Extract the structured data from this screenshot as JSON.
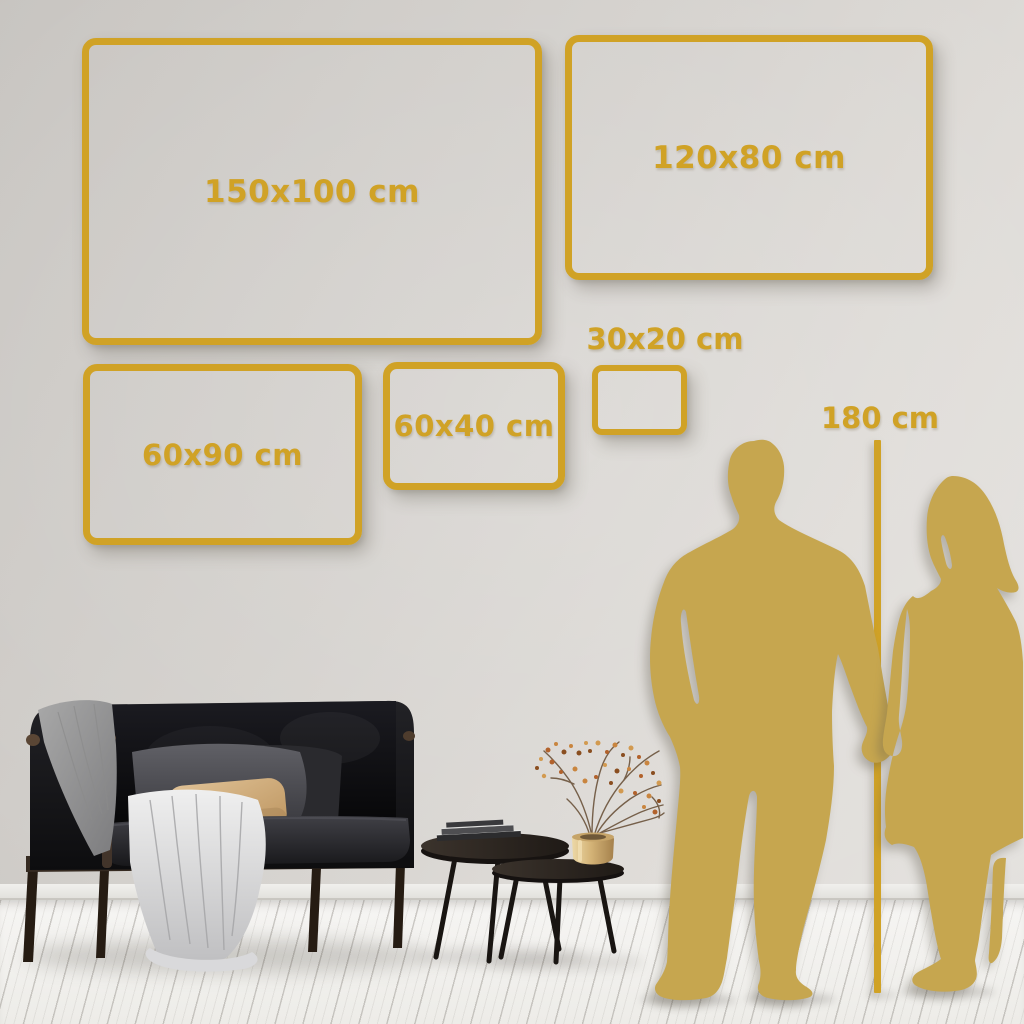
{
  "colors": {
    "accent_gold": "#D0A226",
    "silhouette_gold": "#C6A64F",
    "wall": "#D6D3CF",
    "floor": "#F2F1EE"
  },
  "size_frames": [
    {
      "id": "150x100",
      "label": "150x100 cm",
      "width_cm": 150,
      "height_cm": 100
    },
    {
      "id": "120x80",
      "label": "120x80 cm",
      "width_cm": 120,
      "height_cm": 80
    },
    {
      "id": "60x90",
      "label": "60x90 cm",
      "width_cm": 60,
      "height_cm": 90
    },
    {
      "id": "60x40",
      "label": "60x40 cm",
      "width_cm": 60,
      "height_cm": 40
    },
    {
      "id": "30x20",
      "label": "30x20 cm",
      "width_cm": 30,
      "height_cm": 20
    }
  ],
  "height_reference": {
    "label": "180 cm",
    "height_cm": 180
  }
}
